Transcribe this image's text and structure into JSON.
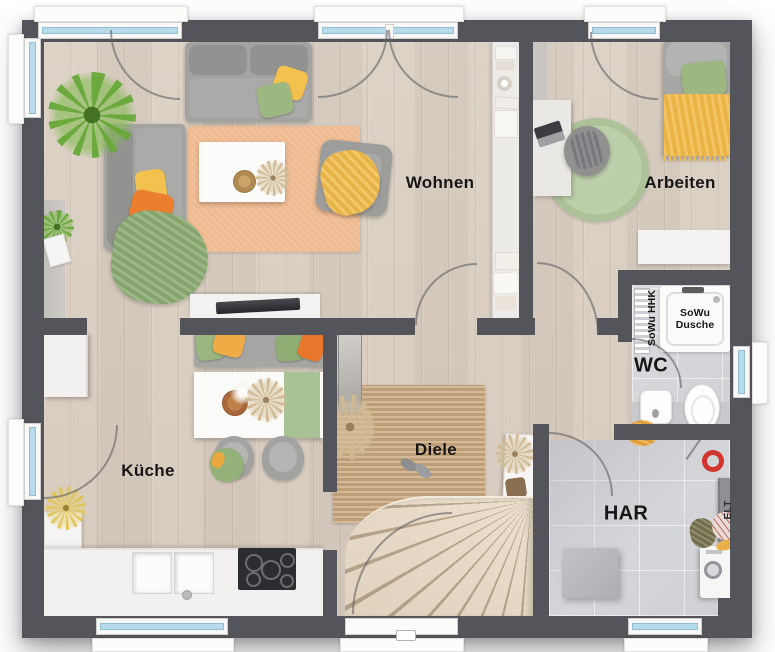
{
  "plan": {
    "rooms": [
      {
        "id": "wohnen",
        "label": "Wohnen"
      },
      {
        "id": "arbeiten",
        "label": "Arbeiten"
      },
      {
        "id": "kueche",
        "label": "Küche"
      },
      {
        "id": "diele",
        "label": "Diele"
      },
      {
        "id": "wc",
        "label": "WC"
      },
      {
        "id": "har",
        "label": "HAR"
      }
    ],
    "fixtures": {
      "shower_label": "SoWu Dusche",
      "radiator_label": "SoWu HHK",
      "electrical_label": "ELT"
    },
    "colors": {
      "wall": "#54555a",
      "wood_floor": "#d8ccbf",
      "tile_floor": "#d6d7d9",
      "rug_orange": "#efba90",
      "rug_green": "#b5c8a2",
      "rug_jute": "#c8a77d",
      "accent_yellow": "#f2bd4c",
      "accent_orange": "#ec7f2e",
      "accent_green": "#9cb77f",
      "window_glass": "#b7dbeb"
    }
  }
}
